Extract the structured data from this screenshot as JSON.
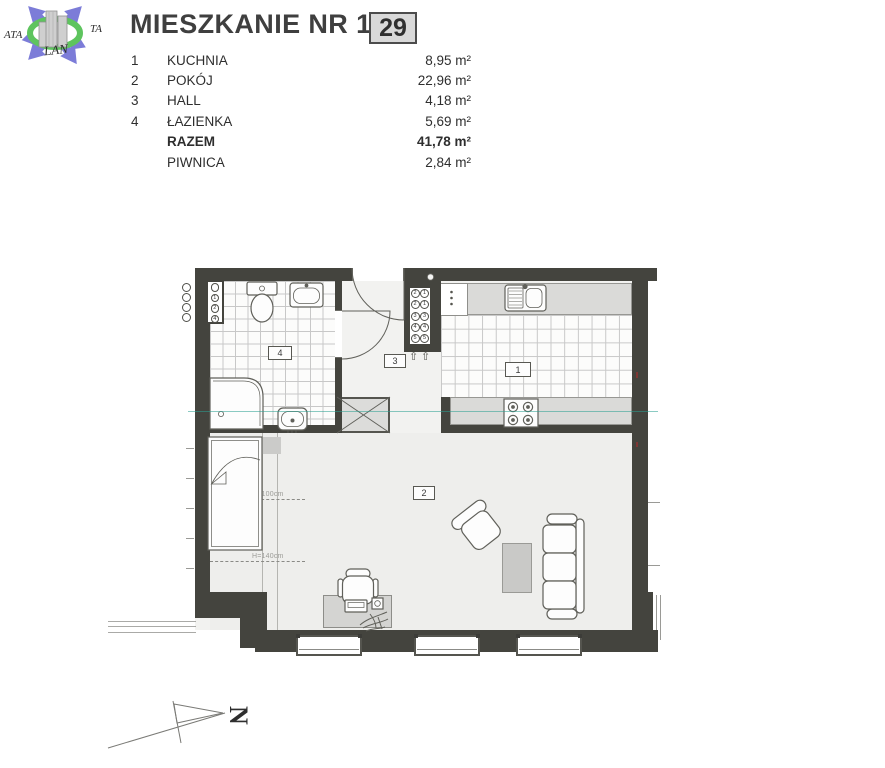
{
  "header": {
    "title": "MIESZKANIE NR 1/5",
    "unit_badge": "29"
  },
  "room_table": {
    "rows": [
      {
        "no": "1",
        "name": "KUCHNIA",
        "area": "8,95 m²"
      },
      {
        "no": "2",
        "name": "POKÓJ",
        "area": "22,96 m²"
      },
      {
        "no": "3",
        "name": "HALL",
        "area": "4,18 m²"
      },
      {
        "no": "4",
        "name": "ŁAZIENKA",
        "area": "5,69 m²"
      },
      {
        "no": "",
        "name": "RAZEM",
        "area": "41,78 m²"
      },
      {
        "no": "",
        "name": "PIWNICA",
        "area": "2,84 m²"
      }
    ]
  },
  "logo": {
    "text_left": "ATA",
    "text_right": "TA",
    "text_bottom": "LAN",
    "arrow_color": "#7c7cd8",
    "ring_color": "#5ec45e",
    "building_color": "#cfcfcf"
  },
  "plan": {
    "wall_color": "#44443e",
    "room_labels": {
      "kitchen": "1",
      "living": "2",
      "hall": "3",
      "bathroom": "4"
    },
    "height_labels": {
      "first": "H=100cm",
      "second": "H=140cm"
    },
    "meter_cabinet": {
      "numbers": [
        "2",
        "1",
        "2",
        "1",
        "3",
        "3",
        "4",
        "4",
        "5",
        "5"
      ],
      "arrow_glyph": "⇧"
    },
    "riser_numbers": [
      "",
      "1",
      "2",
      "4"
    ]
  },
  "compass": {
    "letter": "N"
  }
}
